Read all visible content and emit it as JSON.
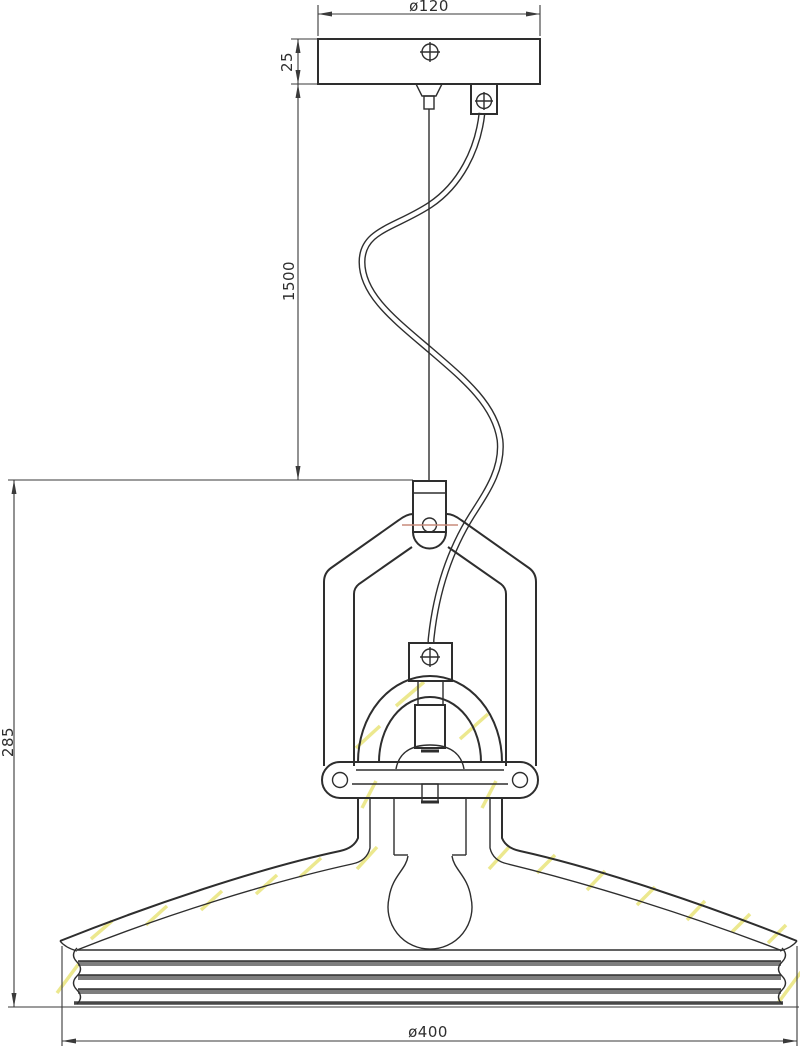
{
  "page": {
    "background": "#ffffff",
    "width": 800,
    "height": 1049
  },
  "drawing": {
    "subject": "Industrial pendant lamp - dimensioned technical drawing, front elevation",
    "line_color": "#2e2e2e",
    "accent_colors": {
      "glass_section_hatch": "#ece88e",
      "rim_rib_band": "#7e7e7e",
      "pivot_centerline_red": "#c98b7c"
    },
    "dimensions": {
      "canopy_diameter": "ø120",
      "canopy_height": "25",
      "suspension_length": "1500",
      "lamp_height": "285",
      "shade_diameter": "ø400"
    },
    "parts": [
      "ceiling-canopy",
      "canopy-screw",
      "cable-gland",
      "strain-relief-box",
      "steel-suspension-cable",
      "power-cord",
      "hanger-bracket",
      "pivot-hole",
      "yoke-frame",
      "yoke-bolt-tabs",
      "cord-grip",
      "lamp-socket",
      "socket-dome",
      "fitter-bracket",
      "glass-shade",
      "ribbed-rim",
      "light-bulb"
    ]
  }
}
